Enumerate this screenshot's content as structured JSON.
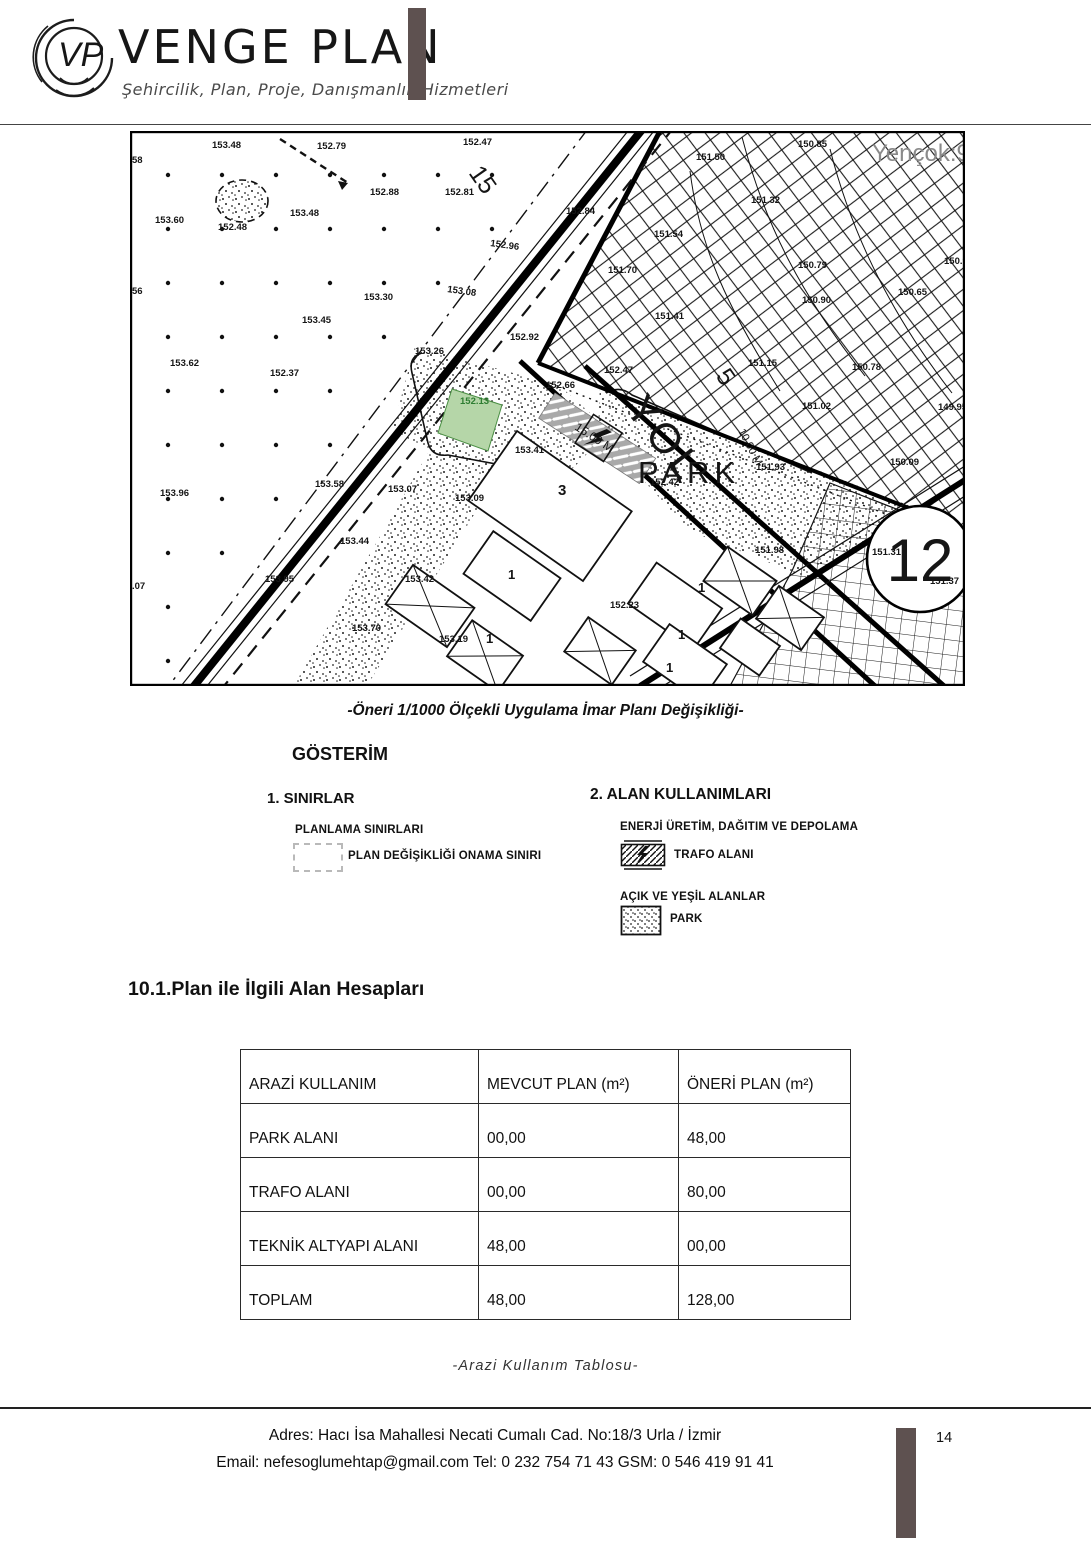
{
  "header": {
    "brand": "VENGE PLAN",
    "tagline": "Şehircilik, Plan, Proje, Danışmanlık Hizmetleri",
    "logo_monogram": "VP"
  },
  "map": {
    "caption": "-Öneri 1/1000 Ölçekli Uygulama İmar Planı Değişikliği-",
    "labels": [
      {
        "t": "153.48",
        "x": 82,
        "y": 17
      },
      {
        "t": "152.79",
        "x": 187,
        "y": 18
      },
      {
        "t": "152.47",
        "x": 333,
        "y": 14
      },
      {
        "t": "150.85",
        "x": 668,
        "y": 16
      },
      {
        "t": "Yençok:9",
        "x": 742,
        "y": 30,
        "s": 24,
        "w": 400,
        "c": "#8a8a8a"
      },
      {
        "t": "58",
        "x": 2,
        "y": 32
      },
      {
        "t": "152.88",
        "x": 240,
        "y": 64
      },
      {
        "t": "152.81",
        "x": 315,
        "y": 64
      },
      {
        "t": "151.50",
        "x": 566,
        "y": 29
      },
      {
        "t": "152.84",
        "x": 436,
        "y": 83
      },
      {
        "t": "151.32",
        "x": 621,
        "y": 72
      },
      {
        "t": "153.60",
        "x": 25,
        "y": 92
      },
      {
        "t": "153.48",
        "x": 160,
        "y": 85
      },
      {
        "t": "152.48",
        "x": 88,
        "y": 99
      },
      {
        "t": "151.54",
        "x": 524,
        "y": 106
      },
      {
        "t": "152.96",
        "x": 360,
        "y": 115,
        "r": 8
      },
      {
        "t": "150.79",
        "x": 668,
        "y": 137
      },
      {
        "t": "150.99",
        "x": 814,
        "y": 133
      },
      {
        "t": "151.70",
        "x": 478,
        "y": 142
      },
      {
        "t": "150.65",
        "x": 768,
        "y": 164
      },
      {
        "t": "150.90",
        "x": 672,
        "y": 172
      },
      {
        "t": "153.08",
        "x": 317,
        "y": 161,
        "r": 8
      },
      {
        "t": "153.30",
        "x": 234,
        "y": 169
      },
      {
        "t": "56",
        "x": 2,
        "y": 163
      },
      {
        "t": "151.41",
        "x": 525,
        "y": 188
      },
      {
        "t": "153.45",
        "x": 172,
        "y": 192
      },
      {
        "t": "152.92",
        "x": 380,
        "y": 209
      },
      {
        "t": "151.15",
        "x": 618,
        "y": 235
      },
      {
        "t": "150.78",
        "x": 722,
        "y": 239
      },
      {
        "t": "153.26",
        "x": 285,
        "y": 223
      },
      {
        "t": "153.62",
        "x": 40,
        "y": 235
      },
      {
        "t": "152.37",
        "x": 140,
        "y": 245
      },
      {
        "t": "152.47",
        "x": 474,
        "y": 242
      },
      {
        "t": "152.66",
        "x": 416,
        "y": 257
      },
      {
        "t": "151.02",
        "x": 672,
        "y": 278
      },
      {
        "t": "149.95",
        "x": 808,
        "y": 279
      },
      {
        "t": "152.13",
        "x": 330,
        "y": 273,
        "c": "#2e7d32"
      },
      {
        "t": "153.41",
        "x": 385,
        "y": 322
      },
      {
        "t": "152.42",
        "x": 520,
        "y": 354
      },
      {
        "t": "151.93",
        "x": 626,
        "y": 339
      },
      {
        "t": "151.98",
        "x": 625,
        "y": 422
      },
      {
        "t": "150.09",
        "x": 760,
        "y": 334
      },
      {
        "t": "151.31",
        "x": 742,
        "y": 424
      },
      {
        "t": "151.37",
        "x": 800,
        "y": 453
      },
      {
        "t": "153.96",
        "x": 30,
        "y": 365
      },
      {
        "t": "153.58",
        "x": 185,
        "y": 356
      },
      {
        "t": "153.07",
        "x": 258,
        "y": 361
      },
      {
        "t": "153.09",
        "x": 325,
        "y": 370
      },
      {
        "t": "153.44",
        "x": 210,
        "y": 413
      },
      {
        "t": "153.95",
        "x": 135,
        "y": 451
      },
      {
        "t": "153.42",
        "x": 275,
        "y": 451
      },
      {
        "t": "153.70",
        "x": 222,
        "y": 500
      },
      {
        "t": "153.19",
        "x": 309,
        "y": 511
      },
      {
        "t": "152.23",
        "x": 480,
        "y": 477
      },
      {
        "t": ".07",
        "x": 2,
        "y": 458
      },
      {
        "t": "15",
        "x": 338,
        "y": 42,
        "r": 55,
        "s": 25,
        "w": 400
      },
      {
        "t": "5",
        "x": 585,
        "y": 245,
        "r": 55,
        "s": 25,
        "w": 400
      },
      {
        "t": "YOL",
        "x": 494,
        "y": 278,
        "r": 52,
        "s": 42,
        "w": 400,
        "ls": 4
      },
      {
        "t": "PARK",
        "x": 508,
        "y": 352,
        "s": 31,
        "w": 400,
        "ls": 5
      },
      {
        "t": "15.00 M",
        "x": 444,
        "y": 298,
        "r": 33,
        "s": 12,
        "w": 400
      },
      {
        "t": "10.00 M",
        "x": 608,
        "y": 300,
        "r": 62,
        "s": 11,
        "w": 400
      },
      {
        "t": "12",
        "x": 790,
        "y": 450,
        "s": 60,
        "w": 400,
        "a": "middle"
      },
      {
        "t": "3",
        "x": 428,
        "y": 364,
        "s": 15
      },
      {
        "t": "1",
        "x": 378,
        "y": 448,
        "s": 13
      },
      {
        "t": "1",
        "x": 356,
        "y": 512,
        "s": 13
      },
      {
        "t": "1",
        "x": 568,
        "y": 461,
        "s": 13
      },
      {
        "t": "1",
        "x": 548,
        "y": 508,
        "s": 13
      },
      {
        "t": "1",
        "x": 536,
        "y": 541,
        "s": 13
      }
    ]
  },
  "legend": {
    "title": "GÖSTERİM",
    "section1": {
      "title": "1. SINIRLAR",
      "subtitle": "PLANLAMA SINIRLARI",
      "item": "PLAN DEĞİŞİKLİĞİ ONAMA SINIRI"
    },
    "section2": {
      "title": "2. ALAN KULLANIMLARI",
      "group1": "ENERJİ ÜRETİM, DAĞITIM VE DEPOLAMA",
      "item1": "TRAFO ALANI",
      "group2": "AÇIK VE YEŞİL ALANLAR",
      "item2": "PARK"
    }
  },
  "section": {
    "heading": "10.1.Plan ile İlgili Alan Hesapları"
  },
  "table": {
    "caption": "-Arazi Kullanım Tablosu-",
    "columns": [
      "ARAZİ KULLANIM",
      "MEVCUT PLAN (m²)",
      "ÖNERİ PLAN (m²)"
    ],
    "rows": [
      [
        "PARK ALANI",
        "00,00",
        "48,00"
      ],
      [
        "TRAFO ALANI",
        "00,00",
        "80,00"
      ],
      [
        "TEKNİK ALTYAPI ALANI",
        "48,00",
        "00,00"
      ],
      [
        "TOPLAM",
        "48,00",
        "128,00"
      ]
    ]
  },
  "footer": {
    "address": "Adres: Hacı İsa Mahallesi Necati Cumalı  Cad. No:18/3  Urla / İzmir",
    "contact": "Email: nefesoglumehtap@gmail.com  Tel: 0 232 754 71 43   GSM: 0 546 419 91 41",
    "page_number": "14"
  },
  "colors": {
    "bar": "#5e5150",
    "green_parcel": "#b5d6a8",
    "trafo_gray": "#a9a9a9"
  }
}
